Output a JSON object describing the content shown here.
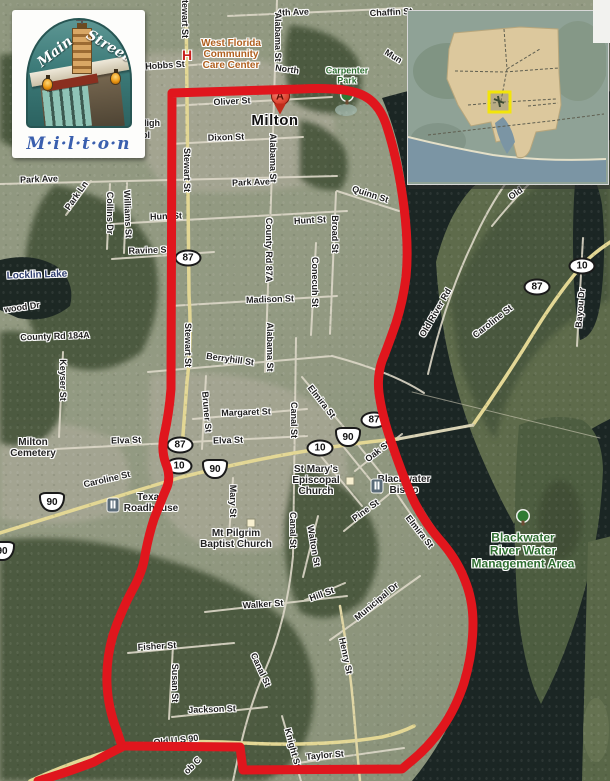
{
  "logo": {
    "word1": "Main",
    "word2": "Street",
    "city": "M·i·l·t·o·n"
  },
  "marker": {
    "letter": "A",
    "city_label": "Milton"
  },
  "colors": {
    "boundary_red": "#e0161d",
    "highlight_yellow": "#f2e50a",
    "county_tan": "#dcc89d",
    "water_dark": "#1b2624",
    "park_green": "#2f6e31",
    "care_center_orange": "#b05f1e"
  },
  "labels": [
    {
      "text": "4th Ave",
      "x": 293,
      "y": 13,
      "rot": -2,
      "cls": "street"
    },
    {
      "text": "Chaffin St",
      "x": 391,
      "y": 13,
      "rot": -3,
      "cls": "street"
    },
    {
      "text": "Mun",
      "x": 393,
      "y": 57,
      "rot": 32,
      "cls": "street"
    },
    {
      "text": "Hobbs St",
      "x": 165,
      "y": 66,
      "rot": -4,
      "cls": "street"
    },
    {
      "text": "North",
      "x": 287,
      "y": 70,
      "rot": 8,
      "cls": "street"
    },
    {
      "text": "Oliver St",
      "x": 232,
      "y": 102,
      "rot": -3,
      "cls": "street"
    },
    {
      "text": "Dixon St",
      "x": 226,
      "y": 138,
      "rot": -2,
      "cls": "street"
    },
    {
      "text": "High",
      "x": 150,
      "y": 124,
      "rot": 0,
      "cls": "street"
    },
    {
      "text": "ol",
      "x": 146,
      "y": 136,
      "rot": 0,
      "cls": "street"
    },
    {
      "text": "Stewart St",
      "x": 184,
      "y": 16,
      "rot": 90,
      "cls": "street"
    },
    {
      "text": "Stewart St",
      "x": 186,
      "y": 170,
      "rot": 90,
      "cls": "street"
    },
    {
      "text": "Stewart St",
      "x": 187,
      "y": 345,
      "rot": 90,
      "cls": "street"
    },
    {
      "text": "Alabama St",
      "x": 277,
      "y": 37,
      "rot": 90,
      "cls": "street"
    },
    {
      "text": "Alabama St",
      "x": 272,
      "y": 158,
      "rot": 90,
      "cls": "street"
    },
    {
      "text": "County Rd 87A",
      "x": 268,
      "y": 250,
      "rot": 90,
      "cls": "street"
    },
    {
      "text": "Alabama St",
      "x": 269,
      "y": 347,
      "rot": 90,
      "cls": "street"
    },
    {
      "text": "Park Ave",
      "x": 39,
      "y": 180,
      "rot": -2,
      "cls": "street"
    },
    {
      "text": "Park Ave",
      "x": 251,
      "y": 183,
      "rot": -2,
      "cls": "street"
    },
    {
      "text": "Park Ln",
      "x": 77,
      "y": 196,
      "rot": -55,
      "cls": "street"
    },
    {
      "text": "Collins Dr",
      "x": 109,
      "y": 213,
      "rot": 90,
      "cls": "street"
    },
    {
      "text": "Williams St",
      "x": 127,
      "y": 214,
      "rot": 88,
      "cls": "street"
    },
    {
      "text": "Hunt St",
      "x": 166,
      "y": 217,
      "rot": -2,
      "cls": "street"
    },
    {
      "text": "Hunt St",
      "x": 310,
      "y": 221,
      "rot": -3,
      "cls": "street"
    },
    {
      "text": "Ravine St",
      "x": 149,
      "y": 251,
      "rot": -2,
      "cls": "street"
    },
    {
      "text": "Quinn St",
      "x": 370,
      "y": 195,
      "rot": 18,
      "cls": "street"
    },
    {
      "text": "Broad St",
      "x": 334,
      "y": 234,
      "rot": 90,
      "cls": "street"
    },
    {
      "text": "Conecuh St",
      "x": 314,
      "y": 282,
      "rot": 90,
      "cls": "street"
    },
    {
      "text": "Madison St",
      "x": 270,
      "y": 300,
      "rot": -2,
      "cls": "street"
    },
    {
      "text": "wood Dr",
      "x": 22,
      "y": 308,
      "rot": -8,
      "cls": "street"
    },
    {
      "text": "County Rd 184A",
      "x": 55,
      "y": 337,
      "rot": -2,
      "cls": "street"
    },
    {
      "text": "Keyser St",
      "x": 62,
      "y": 380,
      "rot": 90,
      "cls": "street"
    },
    {
      "text": "Berryhill St",
      "x": 230,
      "y": 360,
      "rot": 8,
      "cls": "street"
    },
    {
      "text": "Bruner St",
      "x": 206,
      "y": 412,
      "rot": 85,
      "cls": "street"
    },
    {
      "text": "Margaret St",
      "x": 246,
      "y": 413,
      "rot": -2,
      "cls": "street"
    },
    {
      "text": "Canal St",
      "x": 293,
      "y": 420,
      "rot": 90,
      "cls": "street"
    },
    {
      "text": "Canal St",
      "x": 292,
      "y": 530,
      "rot": 90,
      "cls": "street"
    },
    {
      "text": "Canal St",
      "x": 260,
      "y": 670,
      "rot": 65,
      "cls": "street"
    },
    {
      "text": "Elva St",
      "x": 126,
      "y": 441,
      "rot": -2,
      "cls": "street"
    },
    {
      "text": "Elva St",
      "x": 228,
      "y": 441,
      "rot": -2,
      "cls": "street"
    },
    {
      "text": "Caroline St",
      "x": 107,
      "y": 480,
      "rot": -13,
      "cls": "street"
    },
    {
      "text": "Mary St",
      "x": 232,
      "y": 501,
      "rot": 90,
      "cls": "street"
    },
    {
      "text": "Oak St",
      "x": 378,
      "y": 452,
      "rot": -38,
      "cls": "street"
    },
    {
      "text": "Pine St",
      "x": 366,
      "y": 511,
      "rot": -36,
      "cls": "street"
    },
    {
      "text": "Elmira St",
      "x": 321,
      "y": 402,
      "rot": 52,
      "cls": "street"
    },
    {
      "text": "Elmira St",
      "x": 419,
      "y": 532,
      "rot": 52,
      "cls": "street"
    },
    {
      "text": "Walton St",
      "x": 313,
      "y": 546,
      "rot": 80,
      "cls": "street"
    },
    {
      "text": "Walker St",
      "x": 263,
      "y": 605,
      "rot": -4,
      "cls": "street"
    },
    {
      "text": "Fisher St",
      "x": 157,
      "y": 647,
      "rot": -3,
      "cls": "street"
    },
    {
      "text": "Susan St",
      "x": 174,
      "y": 683,
      "rot": 90,
      "cls": "street"
    },
    {
      "text": "Jackson St",
      "x": 212,
      "y": 710,
      "rot": -2,
      "cls": "street"
    },
    {
      "text": "Old U S 90",
      "x": 176,
      "y": 741,
      "rot": -6,
      "cls": "street"
    },
    {
      "text": "ob C",
      "x": 193,
      "y": 766,
      "rot": -45,
      "cls": "street"
    },
    {
      "text": "Knight St",
      "x": 292,
      "y": 748,
      "rot": 75,
      "cls": "street"
    },
    {
      "text": "Taylor St",
      "x": 325,
      "y": 756,
      "rot": -5,
      "cls": "street"
    },
    {
      "text": "Hill St",
      "x": 322,
      "y": 595,
      "rot": -20,
      "cls": "street"
    },
    {
      "text": "Municipal Dr",
      "x": 377,
      "y": 602,
      "rot": -40,
      "cls": "street"
    },
    {
      "text": "Henry St",
      "x": 345,
      "y": 656,
      "rot": 78,
      "cls": "street"
    },
    {
      "text": "Old River Rd",
      "x": 436,
      "y": 313,
      "rot": -60,
      "cls": "street"
    },
    {
      "text": "Caroline St",
      "x": 493,
      "y": 322,
      "rot": -38,
      "cls": "street"
    },
    {
      "text": "Bayou Dr",
      "x": 581,
      "y": 308,
      "rot": -85,
      "cls": "street"
    },
    {
      "text": "Old",
      "x": 516,
      "y": 194,
      "rot": -35,
      "cls": "street"
    },
    {
      "text": "Milton",
      "x": 275,
      "y": 121,
      "rot": 0,
      "cls": "city",
      "name": "city-label-milton"
    },
    {
      "text": "Locklin Lake",
      "x": 37,
      "y": 276,
      "rot": -2,
      "cls": "water",
      "name": "lake-label"
    },
    {
      "lines": [
        "Carpenter",
        "Park"
      ],
      "x": 347,
      "y": 76,
      "rot": 0,
      "cls": "park",
      "name": "park-label"
    },
    {
      "lines": [
        "Blackwater",
        "River Water",
        "Management Area"
      ],
      "x": 523,
      "y": 551,
      "rot": 0,
      "cls": "area",
      "name": "management-area-label"
    },
    {
      "lines": [
        "West Florida",
        "Community",
        "Care Center"
      ],
      "x": 231,
      "y": 55,
      "rot": 0,
      "cls": "carecenter",
      "name": "care-center-label"
    },
    {
      "lines": [
        "Milton",
        "Cemetery"
      ],
      "x": 33,
      "y": 449,
      "rot": 0,
      "cls": "poi",
      "name": "cemetery-label"
    },
    {
      "lines": [
        "Texas",
        "Roadhouse"
      ],
      "x": 151,
      "y": 504,
      "rot": 0,
      "cls": "poi",
      "name": "restaurant-label"
    },
    {
      "lines": [
        "St Mary's",
        "Episcopal",
        "Church"
      ],
      "x": 316,
      "y": 481,
      "rot": 0,
      "cls": "poi",
      "name": "church-label"
    },
    {
      "lines": [
        "Blackwater",
        "Bistro"
      ],
      "x": 404,
      "y": 486,
      "rot": 0,
      "cls": "poi",
      "name": "restaurant-label"
    },
    {
      "lines": [
        "Mt Pilgrim",
        "Baptist Church"
      ],
      "x": 236,
      "y": 540,
      "rot": 0,
      "cls": "poi",
      "name": "church-label"
    }
  ],
  "shields": [
    {
      "kind": "ellipse",
      "label": "87",
      "x": 188,
      "y": 258
    },
    {
      "kind": "ellipse",
      "label": "87",
      "x": 180,
      "y": 445
    },
    {
      "kind": "ellipse",
      "label": "10",
      "x": 179,
      "y": 466
    },
    {
      "kind": "us",
      "label": "90",
      "x": 215,
      "y": 469
    },
    {
      "kind": "us",
      "label": "90",
      "x": 52,
      "y": 502
    },
    {
      "kind": "ellipse",
      "label": "87",
      "x": 374,
      "y": 420
    },
    {
      "kind": "us",
      "label": "90",
      "x": 348,
      "y": 437
    },
    {
      "kind": "ellipse",
      "label": "10",
      "x": 320,
      "y": 448
    },
    {
      "kind": "ellipse",
      "label": "87",
      "x": 537,
      "y": 287
    },
    {
      "kind": "ellipse",
      "label": "10",
      "x": 582,
      "y": 266
    },
    {
      "kind": "us",
      "label": "90",
      "x": 2,
      "y": 551
    }
  ],
  "icons": [
    {
      "type": "hospital",
      "x": 187,
      "y": 55,
      "glyph": "H"
    },
    {
      "type": "tree",
      "x": 347,
      "y": 97
    },
    {
      "type": "tree",
      "x": 523,
      "y": 518
    },
    {
      "type": "restaurant",
      "x": 113,
      "y": 505
    },
    {
      "type": "restaurant",
      "x": 377,
      "y": 486
    },
    {
      "type": "square",
      "x": 350,
      "y": 481
    },
    {
      "type": "square",
      "x": 251,
      "y": 523
    },
    {
      "type": "pin",
      "x": 280,
      "y": 102,
      "letter": "A"
    }
  ]
}
